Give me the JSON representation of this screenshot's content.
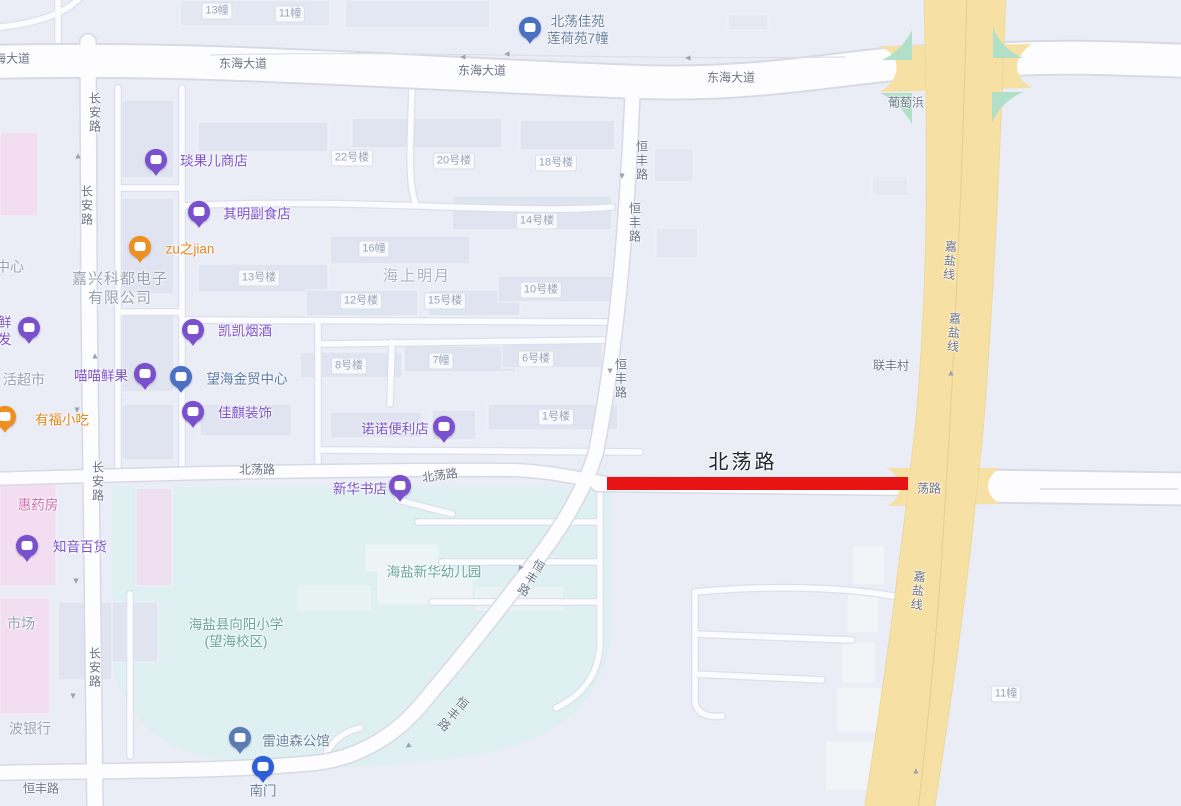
{
  "map": {
    "colors": {
      "background": "#eaedf6",
      "road_fill": "#fdfdff",
      "road_casing": "#d7dae4",
      "major_road": "#f7e0a3",
      "major_road_edge": "#ecd9a0",
      "green_island": "#b2dfc7",
      "campus": "#def0f1",
      "building": "#e0e4f0",
      "building_pink": "#f3def1",
      "highlight_red": "#e81414",
      "poi_purple": "#7b50cc",
      "poi_orange": "#ef8f1f",
      "poi_blue": "#4a70c2",
      "poi_steel": "#5b7bb2",
      "poi_station": "#2e5fd7"
    },
    "labels": [
      {
        "id": "road-label-donghai-w",
        "text": "东海大道",
        "x": 6,
        "y": 59,
        "cls": "rl"
      },
      {
        "id": "road-label-donghai-c1",
        "text": "东海大道",
        "x": 243,
        "y": 64,
        "cls": "rl"
      },
      {
        "id": "road-label-donghai-c2",
        "text": "东海大道",
        "x": 482,
        "y": 71,
        "cls": "rl"
      },
      {
        "id": "road-label-donghai-e",
        "text": "东海大道",
        "x": 731,
        "y": 78,
        "cls": "rl"
      },
      {
        "id": "label-putaobang",
        "text": "葡萄浜",
        "x": 906,
        "y": 103,
        "cls": "rl"
      },
      {
        "id": "road-label-changan-1",
        "text": "长安路",
        "x": 94,
        "y": 113,
        "cls": "rl",
        "vertical": true
      },
      {
        "id": "road-label-changan-2",
        "text": "长安路",
        "x": 86,
        "y": 206,
        "cls": "rl",
        "vertical": true
      },
      {
        "id": "road-label-changan-3",
        "text": "长安路",
        "x": 97,
        "y": 482,
        "cls": "rl",
        "vertical": true
      },
      {
        "id": "road-label-changan-4",
        "text": "长安路",
        "x": 94,
        "y": 668,
        "cls": "rl",
        "vertical": true
      },
      {
        "id": "road-label-hengfeng-1",
        "text": "恒丰路",
        "x": 641,
        "y": 161,
        "cls": "rl",
        "vertical": true
      },
      {
        "id": "road-label-hengfeng-2",
        "text": "恒丰路",
        "x": 634,
        "y": 223,
        "cls": "rl",
        "vertical": true
      },
      {
        "id": "road-label-hengfeng-3",
        "text": "恒丰路",
        "x": 620,
        "y": 379,
        "cls": "rl",
        "vertical": true
      },
      {
        "id": "road-label-hengfeng-4",
        "text": "恒丰路",
        "x": 530,
        "y": 578,
        "cls": "rl",
        "vertical": true,
        "rot": 31
      },
      {
        "id": "road-label-hengfeng-5",
        "text": "恒丰路",
        "x": 452,
        "y": 714,
        "cls": "rl",
        "vertical": true,
        "rot": 40
      },
      {
        "id": "road-label-hengfeng-6",
        "text": "恒丰路",
        "x": 41,
        "y": 789,
        "cls": "rl"
      },
      {
        "id": "road-label-jiayan-1",
        "text": "嘉盐线",
        "x": 949,
        "y": 261,
        "cls": "rl",
        "vertical": true,
        "rot": 4
      },
      {
        "id": "road-label-jiayan-2",
        "text": "嘉盐线",
        "x": 953,
        "y": 333,
        "cls": "rl",
        "vertical": true,
        "rot": 4
      },
      {
        "id": "road-label-jiayan-3",
        "text": "嘉盐线",
        "x": 917,
        "y": 591,
        "cls": "rl",
        "vertical": true,
        "rot": 6
      },
      {
        "id": "label-lianfengcun",
        "text": "联丰村",
        "x": 891,
        "y": 366,
        "cls": "rl"
      },
      {
        "id": "road-label-beidang-1",
        "text": "北荡路",
        "x": 257,
        "y": 470,
        "cls": "rl"
      },
      {
        "id": "road-label-beidang-2",
        "text": "北荡路",
        "x": 440,
        "y": 476,
        "cls": "rl",
        "rot": -8
      },
      {
        "id": "road-label-beidang-big",
        "text": "北荡路",
        "x": 743,
        "y": 463,
        "cls": "rl big"
      },
      {
        "id": "road-label-beidang-3",
        "text": "荡路",
        "x": 929,
        "y": 489,
        "cls": "rl"
      },
      {
        "id": "label-haishangmingyue",
        "text": "海上明月",
        "x": 417,
        "y": 277,
        "cls": "area big"
      },
      {
        "id": "label-company",
        "text": "嘉兴科都电子\n有限公司",
        "x": 120,
        "y": 289,
        "cls": "company"
      },
      {
        "id": "label-zhongxin",
        "text": "中心",
        "x": 10,
        "y": 267,
        "cls": "area mid"
      },
      {
        "id": "label-huochaoshi",
        "text": "活超市",
        "x": 24,
        "y": 380,
        "cls": "area mid"
      },
      {
        "id": "label-shichang",
        "text": "市场",
        "x": 21,
        "y": 624,
        "cls": "area mid"
      },
      {
        "id": "label-boyinhang",
        "text": "波银行",
        "x": 30,
        "y": 729,
        "cls": "area mid"
      },
      {
        "id": "label-youeryuan",
        "text": "海盐新华幼儿园",
        "x": 434,
        "y": 573,
        "cls": "teal"
      },
      {
        "id": "label-xiaoxue",
        "text": "海盐县向阳小学\n(望海校区)",
        "x": 236,
        "y": 634,
        "cls": "teal"
      },
      {
        "id": "bld-13zhuang",
        "text": "13幢",
        "x": 217,
        "y": 11,
        "cls": "bl"
      },
      {
        "id": "bld-11zhuang-top",
        "text": "11幢",
        "x": 290,
        "y": 14,
        "cls": "bl"
      },
      {
        "id": "bld-22haolou",
        "text": "22号楼",
        "x": 352,
        "y": 158,
        "cls": "bl"
      },
      {
        "id": "bld-20haolou",
        "text": "20号楼",
        "x": 454,
        "y": 161,
        "cls": "bl"
      },
      {
        "id": "bld-18haolou",
        "text": "18号楼",
        "x": 556,
        "y": 163,
        "cls": "bl"
      },
      {
        "id": "bld-14haolou",
        "text": "14号楼",
        "x": 537,
        "y": 221,
        "cls": "bl"
      },
      {
        "id": "bld-16zhuang",
        "text": "16幢",
        "x": 374,
        "y": 249,
        "cls": "bl"
      },
      {
        "id": "bld-13haolou",
        "text": "13号楼",
        "x": 259,
        "y": 278,
        "cls": "bl"
      },
      {
        "id": "bld-12haolou",
        "text": "12号楼",
        "x": 361,
        "y": 301,
        "cls": "bl"
      },
      {
        "id": "bld-15haolou",
        "text": "15号楼",
        "x": 445,
        "y": 301,
        "cls": "bl"
      },
      {
        "id": "bld-10haolou",
        "text": "10号楼",
        "x": 541,
        "y": 290,
        "cls": "bl"
      },
      {
        "id": "bld-8haolou",
        "text": "8号楼",
        "x": 349,
        "y": 366,
        "cls": "bl"
      },
      {
        "id": "bld-7zhuang",
        "text": "7幢",
        "x": 441,
        "y": 361,
        "cls": "bl"
      },
      {
        "id": "bld-6haolou",
        "text": "6号楼",
        "x": 536,
        "y": 359,
        "cls": "bl"
      },
      {
        "id": "bld-1haolou",
        "text": "1号楼",
        "x": 556,
        "y": 417,
        "cls": "bl"
      },
      {
        "id": "bld-11zhuang-br",
        "text": "11幢",
        "x": 1006,
        "y": 694,
        "cls": "bl"
      }
    ],
    "pois": [
      {
        "id": "poi-yanguoer",
        "name": "琰果儿商店",
        "pin": {
          "x": 156,
          "y": 163,
          "color": "#7b50cc"
        },
        "text": {
          "x": 214,
          "y": 162
        }
      },
      {
        "id": "poi-qiming",
        "name": "其明副食店",
        "pin": {
          "x": 199,
          "y": 215,
          "color": "#7b50cc"
        },
        "text": {
          "x": 257,
          "y": 215
        }
      },
      {
        "id": "poi-zujian",
        "name": "zu之jian",
        "pin": {
          "x": 140,
          "y": 250,
          "color": "#ef8f1f"
        },
        "text": {
          "x": 190,
          "y": 250,
          "color": "#e4871c"
        }
      },
      {
        "id": "poi-kaikai",
        "name": "凯凯烟酒",
        "pin": {
          "x": 193,
          "y": 333,
          "color": "#7b50cc"
        },
        "text": {
          "x": 245,
          "y": 332
        }
      },
      {
        "id": "poi-miaomiao",
        "name": "喵喵鲜果",
        "pin": {
          "x": 145,
          "y": 377,
          "color": "#7b50cc"
        },
        "text": {
          "x": 101,
          "y": 377
        }
      },
      {
        "id": "poi-wanghai",
        "name": "望海金贸中心",
        "pin": {
          "x": 181,
          "y": 380,
          "color": "#4a70c2"
        },
        "text": {
          "x": 247,
          "y": 380,
          "color": "#5878ab"
        }
      },
      {
        "id": "poi-jiaqi",
        "name": "佳麒装饰",
        "pin": {
          "x": 193,
          "y": 415,
          "color": "#7b50cc"
        },
        "text": {
          "x": 245,
          "y": 414
        }
      },
      {
        "id": "poi-nuonuo",
        "name": "诺诺便利店",
        "pin": {
          "x": 444,
          "y": 430,
          "color": "#7b50cc"
        },
        "text": {
          "x": 395,
          "y": 430
        }
      },
      {
        "id": "poi-xinhua",
        "name": "新华书店",
        "pin": {
          "x": 400,
          "y": 489,
          "color": "#7b50cc"
        },
        "text": {
          "x": 360,
          "y": 490
        }
      },
      {
        "id": "poi-zhiyin",
        "name": "知音百货",
        "pin": {
          "x": 27,
          "y": 549,
          "color": "#7b50cc"
        },
        "text": {
          "x": 80,
          "y": 548
        }
      },
      {
        "id": "poi-shengxian",
        "name": "生鲜\n批发",
        "pin": {
          "x": 29,
          "y": 331,
          "color": "#7b50cc"
        },
        "text": {
          "x": -2,
          "y": 332
        }
      },
      {
        "id": "poi-youfu",
        "name": "有福小吃",
        "pin": {
          "x": 5,
          "y": 420,
          "color": "#ef8f1f"
        },
        "text": {
          "x": 62,
          "y": 421,
          "color": "#e4871c"
        }
      },
      {
        "id": "poi-huiyaofang",
        "name": "惠药房",
        "text": {
          "x": 38,
          "y": 506,
          "color": "#cf6fae"
        }
      },
      {
        "id": "poi-beidangjiayuan",
        "name": "北荡佳苑\n莲荷苑7幢",
        "pin": {
          "x": 530,
          "y": 31,
          "color": "#4a70c2"
        },
        "text": {
          "x": 547,
          "y": 31,
          "anchor": "left",
          "color": "#68809f"
        }
      },
      {
        "id": "poi-leidisen",
        "name": "雷迪森公馆",
        "pin": {
          "x": 240,
          "y": 741,
          "color": "#5b7bb2"
        },
        "text": {
          "x": 296,
          "y": 742,
          "color": "#68809f"
        }
      },
      {
        "id": "poi-nanmen",
        "name": "南门",
        "pin": {
          "x": 263,
          "y": 770,
          "color": "#2e5fd7"
        },
        "text": {
          "x": 263,
          "y": 792,
          "color": "#68809f"
        }
      }
    ],
    "arrows": [
      {
        "x": 463,
        "y": 57,
        "rot": 270
      },
      {
        "x": 507,
        "y": 54,
        "rot": 270
      },
      {
        "x": 688,
        "y": 58,
        "rot": 270
      },
      {
        "x": 622,
        "y": 176,
        "rot": 180
      },
      {
        "x": 78,
        "y": 156,
        "rot": 0
      },
      {
        "x": 95,
        "y": 356,
        "rot": 0
      },
      {
        "x": 77,
        "y": 410,
        "rot": 180
      },
      {
        "x": 76,
        "y": 581,
        "rot": 180
      },
      {
        "x": 73,
        "y": 696,
        "rot": 180
      },
      {
        "x": 610,
        "y": 371,
        "rot": 180
      },
      {
        "x": 520,
        "y": 568,
        "rot": 210
      },
      {
        "x": 408,
        "y": 746,
        "rot": 235
      },
      {
        "x": 951,
        "y": 373,
        "rot": 0
      },
      {
        "x": 916,
        "y": 771,
        "rot": 0
      }
    ]
  }
}
